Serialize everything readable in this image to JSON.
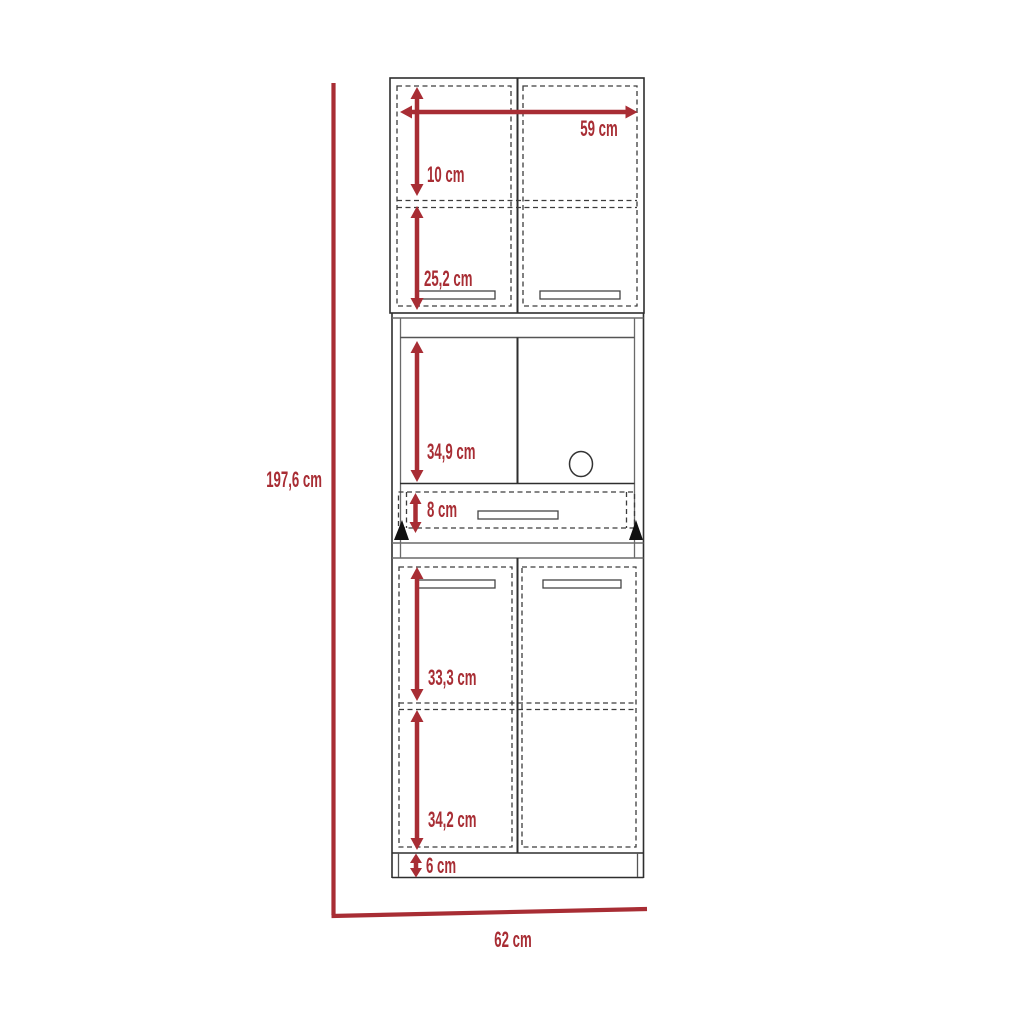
{
  "diagram": {
    "kind": "furniture-dimension-drawing",
    "subject": "tall pantry cabinet front elevation",
    "accent_color": "#a82d34",
    "line_color": "#2e2e2e",
    "units": "cm"
  },
  "labels": {
    "overall_height": "197,6 cm",
    "overall_width": "62 cm",
    "top_width": "59 cm",
    "top_shelf_height": "10 cm",
    "upper_cabinet_height": "25,2 cm",
    "middle_compartment_height": "34,9 cm",
    "drawer_height": "8 cm",
    "lower_upper_section_height": "33,3 cm",
    "lower_bottom_section_height": "34,2 cm",
    "base_height": "6 cm"
  }
}
